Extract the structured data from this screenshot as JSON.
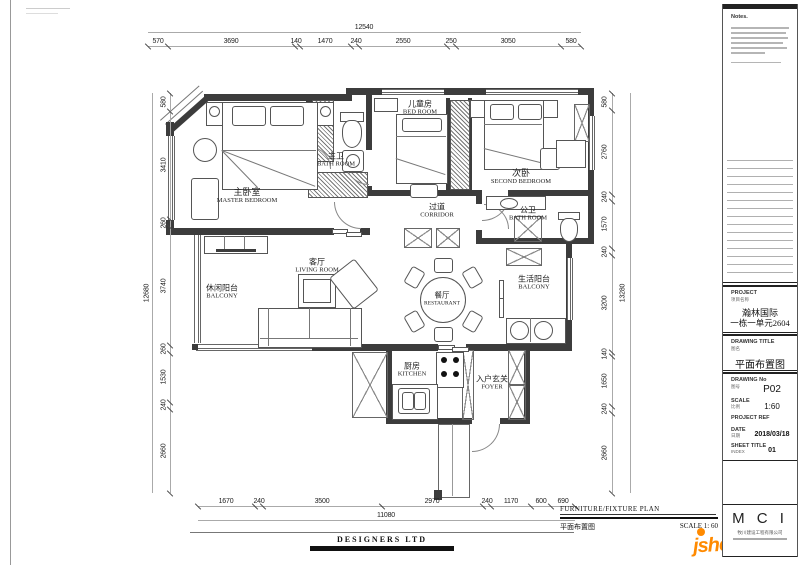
{
  "titleblock": {
    "notes_title": "Notes.",
    "project": {
      "label": "PROJECT",
      "label_cn": "项目名称",
      "line1": "瀚林国际",
      "line2": "一栋一单元2604"
    },
    "drawing_title": {
      "label": "DRAWING  TITLE",
      "label_cn": "图名",
      "value": "平面布置图"
    },
    "drawing_no": {
      "label": "DRAWING No",
      "label_cn": "图号",
      "value": "P02"
    },
    "scale": {
      "label": "SCALE",
      "label_cn": "比例",
      "value": "1:60"
    },
    "project_ref": {
      "label": "PROJECT REF"
    },
    "date": {
      "label": "DATE",
      "label_cn": "日期",
      "value": "2018/03/18"
    },
    "sheet": {
      "label": "SHEET TITLE",
      "label_cn": "INDEX",
      "value": "01"
    },
    "logo": {
      "text": "M C I",
      "sub_cn": "牧川建设工程有限公司"
    }
  },
  "footer": {
    "plan_title_en": "FURNITURE/FIXTURE PLAN",
    "plan_title_cn": "平面布置图",
    "scale_text": "SCALE 1: 60",
    "designers": "DESIGNERS LTD"
  },
  "watermark": {
    "main": "jsheh.com",
    "cn": "建设汇"
  },
  "rooms": [
    {
      "cn": "主卧室",
      "en": "MASTER BEDROOM"
    },
    {
      "cn": "主卫",
      "en": "BATH ROOM"
    },
    {
      "cn": "儿童房",
      "en": "BED ROOM"
    },
    {
      "cn": "次卧",
      "en": "SECOND BEDROOM"
    },
    {
      "cn": "过道",
      "en": "CORRIDOR"
    },
    {
      "cn": "公卫",
      "en": "BATH ROOM"
    },
    {
      "cn": "休闲阳台",
      "en": "BALCONY"
    },
    {
      "cn": "客厅",
      "en": "LIVING ROOM"
    },
    {
      "cn": "餐厅",
      "en": "RESTAURANT"
    },
    {
      "cn": "生活阳台",
      "en": "BALCONY"
    },
    {
      "cn": "厨房",
      "en": "KITCHEN"
    },
    {
      "cn": "入户玄关",
      "en": "FOYER"
    }
  ],
  "dims": {
    "top": {
      "total": "12540",
      "segments": [
        "570",
        "3690",
        "140",
        "1470",
        "240",
        "2550",
        "250",
        "3050",
        "580"
      ]
    },
    "bottom": {
      "total": "11080",
      "segments": [
        "1670",
        "240",
        "3500",
        "2970",
        "240",
        "1170",
        "600",
        "690"
      ]
    },
    "left": {
      "total": "12680",
      "segments": [
        "580",
        "3410",
        "260",
        "3740",
        "260",
        "1530",
        "240",
        "2660"
      ]
    },
    "right": {
      "total": "13280",
      "segments": [
        "580",
        "2760",
        "240",
        "1570",
        "240",
        "3200",
        "140",
        "1650",
        "240",
        "2660"
      ]
    }
  }
}
